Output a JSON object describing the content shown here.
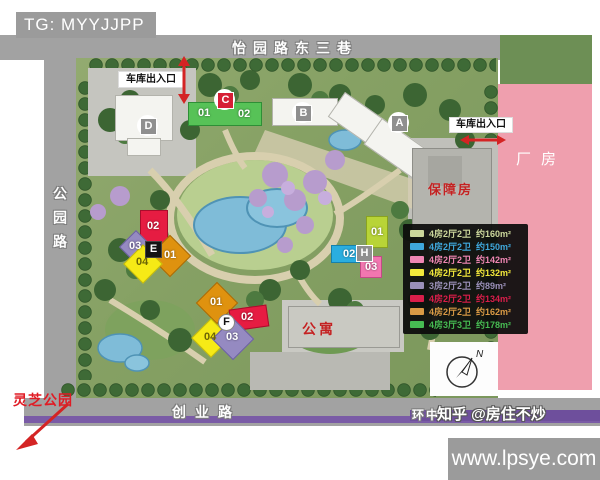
{
  "header": {
    "tg_badge": "TG: MYYJJPP"
  },
  "roads": {
    "top": "怡园路东三巷",
    "left": "公园路",
    "bottom": "创业路",
    "bottom_right": "环中"
  },
  "map": {
    "garage_label_top": "车库出入口",
    "garage_label_right": "车库出入口",
    "factory_label": "厂房",
    "welfare_housing_label": "保障房",
    "apartment_label": "公寓",
    "park_label": "灵芝公园",
    "compass_label": "N"
  },
  "buildings": {
    "a": {
      "label": "A"
    },
    "b": {
      "label": "B"
    },
    "c": {
      "label": "C",
      "units": [
        "01",
        "02"
      ]
    },
    "d": {
      "label": "D"
    },
    "e": {
      "label": "E",
      "units": [
        "01",
        "02",
        "03",
        "04"
      ]
    },
    "f": {
      "label": "F",
      "units": [
        "01",
        "02",
        "03",
        "04"
      ]
    },
    "h": {
      "label": "H",
      "units": [
        "01",
        "02",
        "03"
      ]
    }
  },
  "legend": {
    "rows": [
      {
        "color": "#cbd79b",
        "label": "4房2厅2卫",
        "area": "约160m²"
      },
      {
        "color": "#3fa8dc",
        "label": "4房2厅2卫",
        "area": "约150m²"
      },
      {
        "color": "#ef86b3",
        "label": "4房2厅2卫",
        "area": "约142m²"
      },
      {
        "color": "#f2e83b",
        "label": "4房2厅2卫",
        "area": "约132m²"
      },
      {
        "color": "#9a90b8",
        "label": "3房2厅2卫",
        "area": "约89m²"
      },
      {
        "color": "#d91e4a",
        "label": "4房2厅2卫",
        "area": "约134m²"
      },
      {
        "color": "#d99a45",
        "label": "4房2厅2卫",
        "area": "约162m²"
      },
      {
        "color": "#46bb52",
        "label": "4房3厅3卫",
        "area": "约178m²"
      }
    ]
  },
  "watermark": {
    "zhihu": "知乎 @房住不炒",
    "site": "www.lpsye.com"
  }
}
